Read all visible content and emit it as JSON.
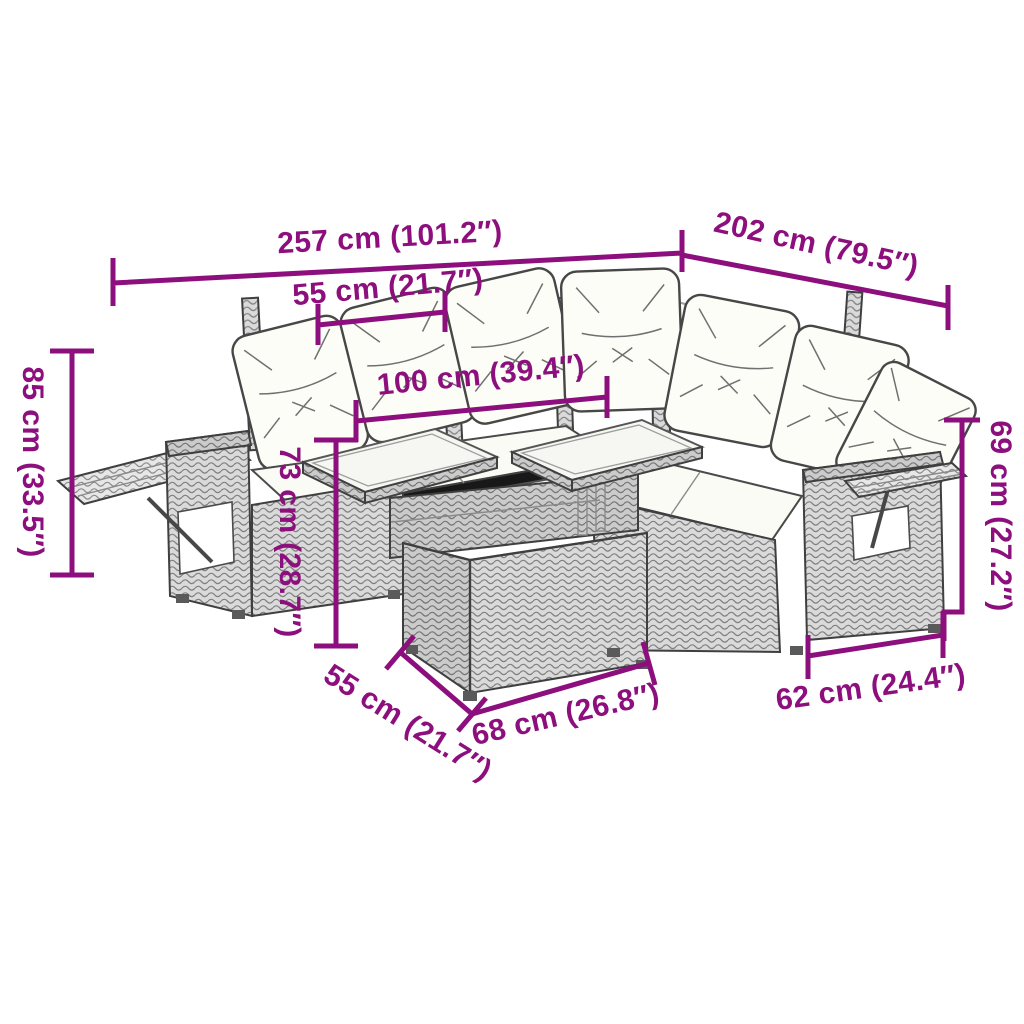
{
  "page": {
    "background": "#ffffff",
    "width": 1024,
    "height": 1024
  },
  "colors": {
    "dimension_annotation": "#8C0F7D",
    "outline": "#3f3f3f",
    "cushion": "#fdfdf8",
    "weave_light": "#e7e7e7",
    "weave_mid": "#dadada",
    "weave_dark": "#cbcbcb"
  },
  "diagram": {
    "type": "product-dimension-diagram",
    "product": "rattan corner garden sofa set with cushions, side trays and two-top table",
    "dimensions": {
      "total_width": "257 cm (101.2″)",
      "total_depth": "202 cm (79.5″)",
      "seat_width_top": "55 cm (21.7″)",
      "table_length": "100 cm (39.4″)",
      "back_height": "85 cm (33.5″)",
      "table_height": "73 cm (28.7″)",
      "right_height": "69 cm (27.2″)",
      "seat_depth_bottom": "55 cm (21.7″)",
      "table_depth": "68 cm (26.8″)",
      "right_seat_width": "62 cm (24.4″)"
    }
  }
}
